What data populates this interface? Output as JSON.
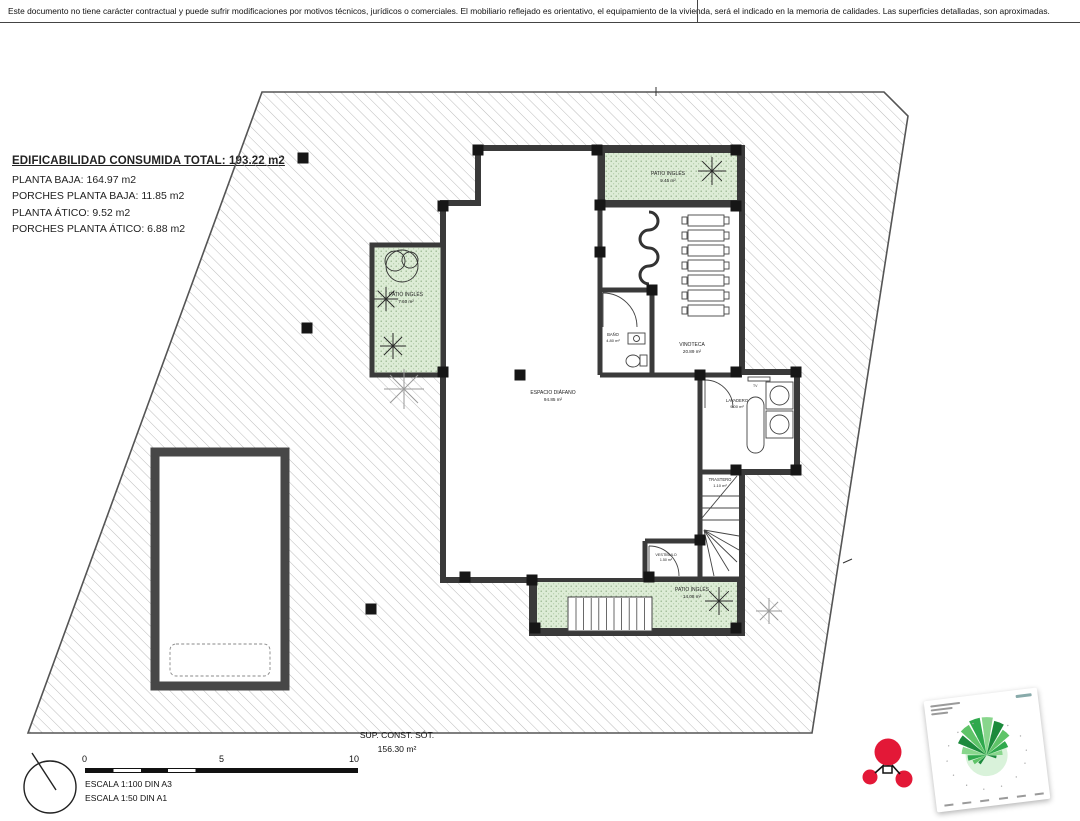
{
  "disclaimer": "Este documento no tiene carácter contractual y puede sufrir modificaciones por motivos técnicos, jurídicos o comerciales. El mobiliario reflejado es orientativo, el equipamiento de la vivienda, será el indicado en la memoria de calidades. Las superficies detalladas, son aproximadas.",
  "edificabilidad": {
    "title": "EDIFICABILIDAD CONSUMIDA TOTAL: 193.22 m2",
    "lines": [
      "PLANTA BAJA: 164.97 m2",
      "PORCHES PLANTA BAJA: 11.85 m2",
      "PLANTA ÁTICO: 9.52 m2",
      "PORCHES PLANTA ÁTICO: 6.88 m2"
    ]
  },
  "rooms": {
    "espacio_diafano": {
      "name": "ESPACIO DIÁFANO",
      "area": "94.85 m²"
    },
    "bano": {
      "name": "BAÑO",
      "area": "4.80 m²"
    },
    "vinoteca": {
      "name": "VINOTECA",
      "area": "20.89 m²"
    },
    "lavadero": {
      "name": "LAVADERO",
      "area": "9.00 m²",
      "tv_label": "TV"
    },
    "trastero": {
      "name": "TRASTERO",
      "area": "1.10 m²"
    },
    "vestibulo": {
      "name": "VESTÍBULO",
      "area": "1.50 m²"
    },
    "patio_top": {
      "name": "PATIO INGLÉS",
      "area": "9.45 m²"
    },
    "patio_left": {
      "name": "PATIO INGLÉS",
      "area": "7.60 m²"
    },
    "patio_bottom": {
      "name": "PATIO INGLÉS",
      "area": "14.08 m²"
    }
  },
  "summary": {
    "title": "SUP. CONST. SÓT.",
    "area": "156.30 m²"
  },
  "scale": {
    "zero": "0",
    "five": "5",
    "ten": "10",
    "line1": "ESCALA 1:100 DIN A3",
    "line2": "ESCALA 1:50 DIN A1"
  },
  "colors": {
    "wall": "#3a3a3a",
    "patio_green": "#ddecd6",
    "logo_red": "#e31837",
    "rose_green": "#2aa94f"
  }
}
